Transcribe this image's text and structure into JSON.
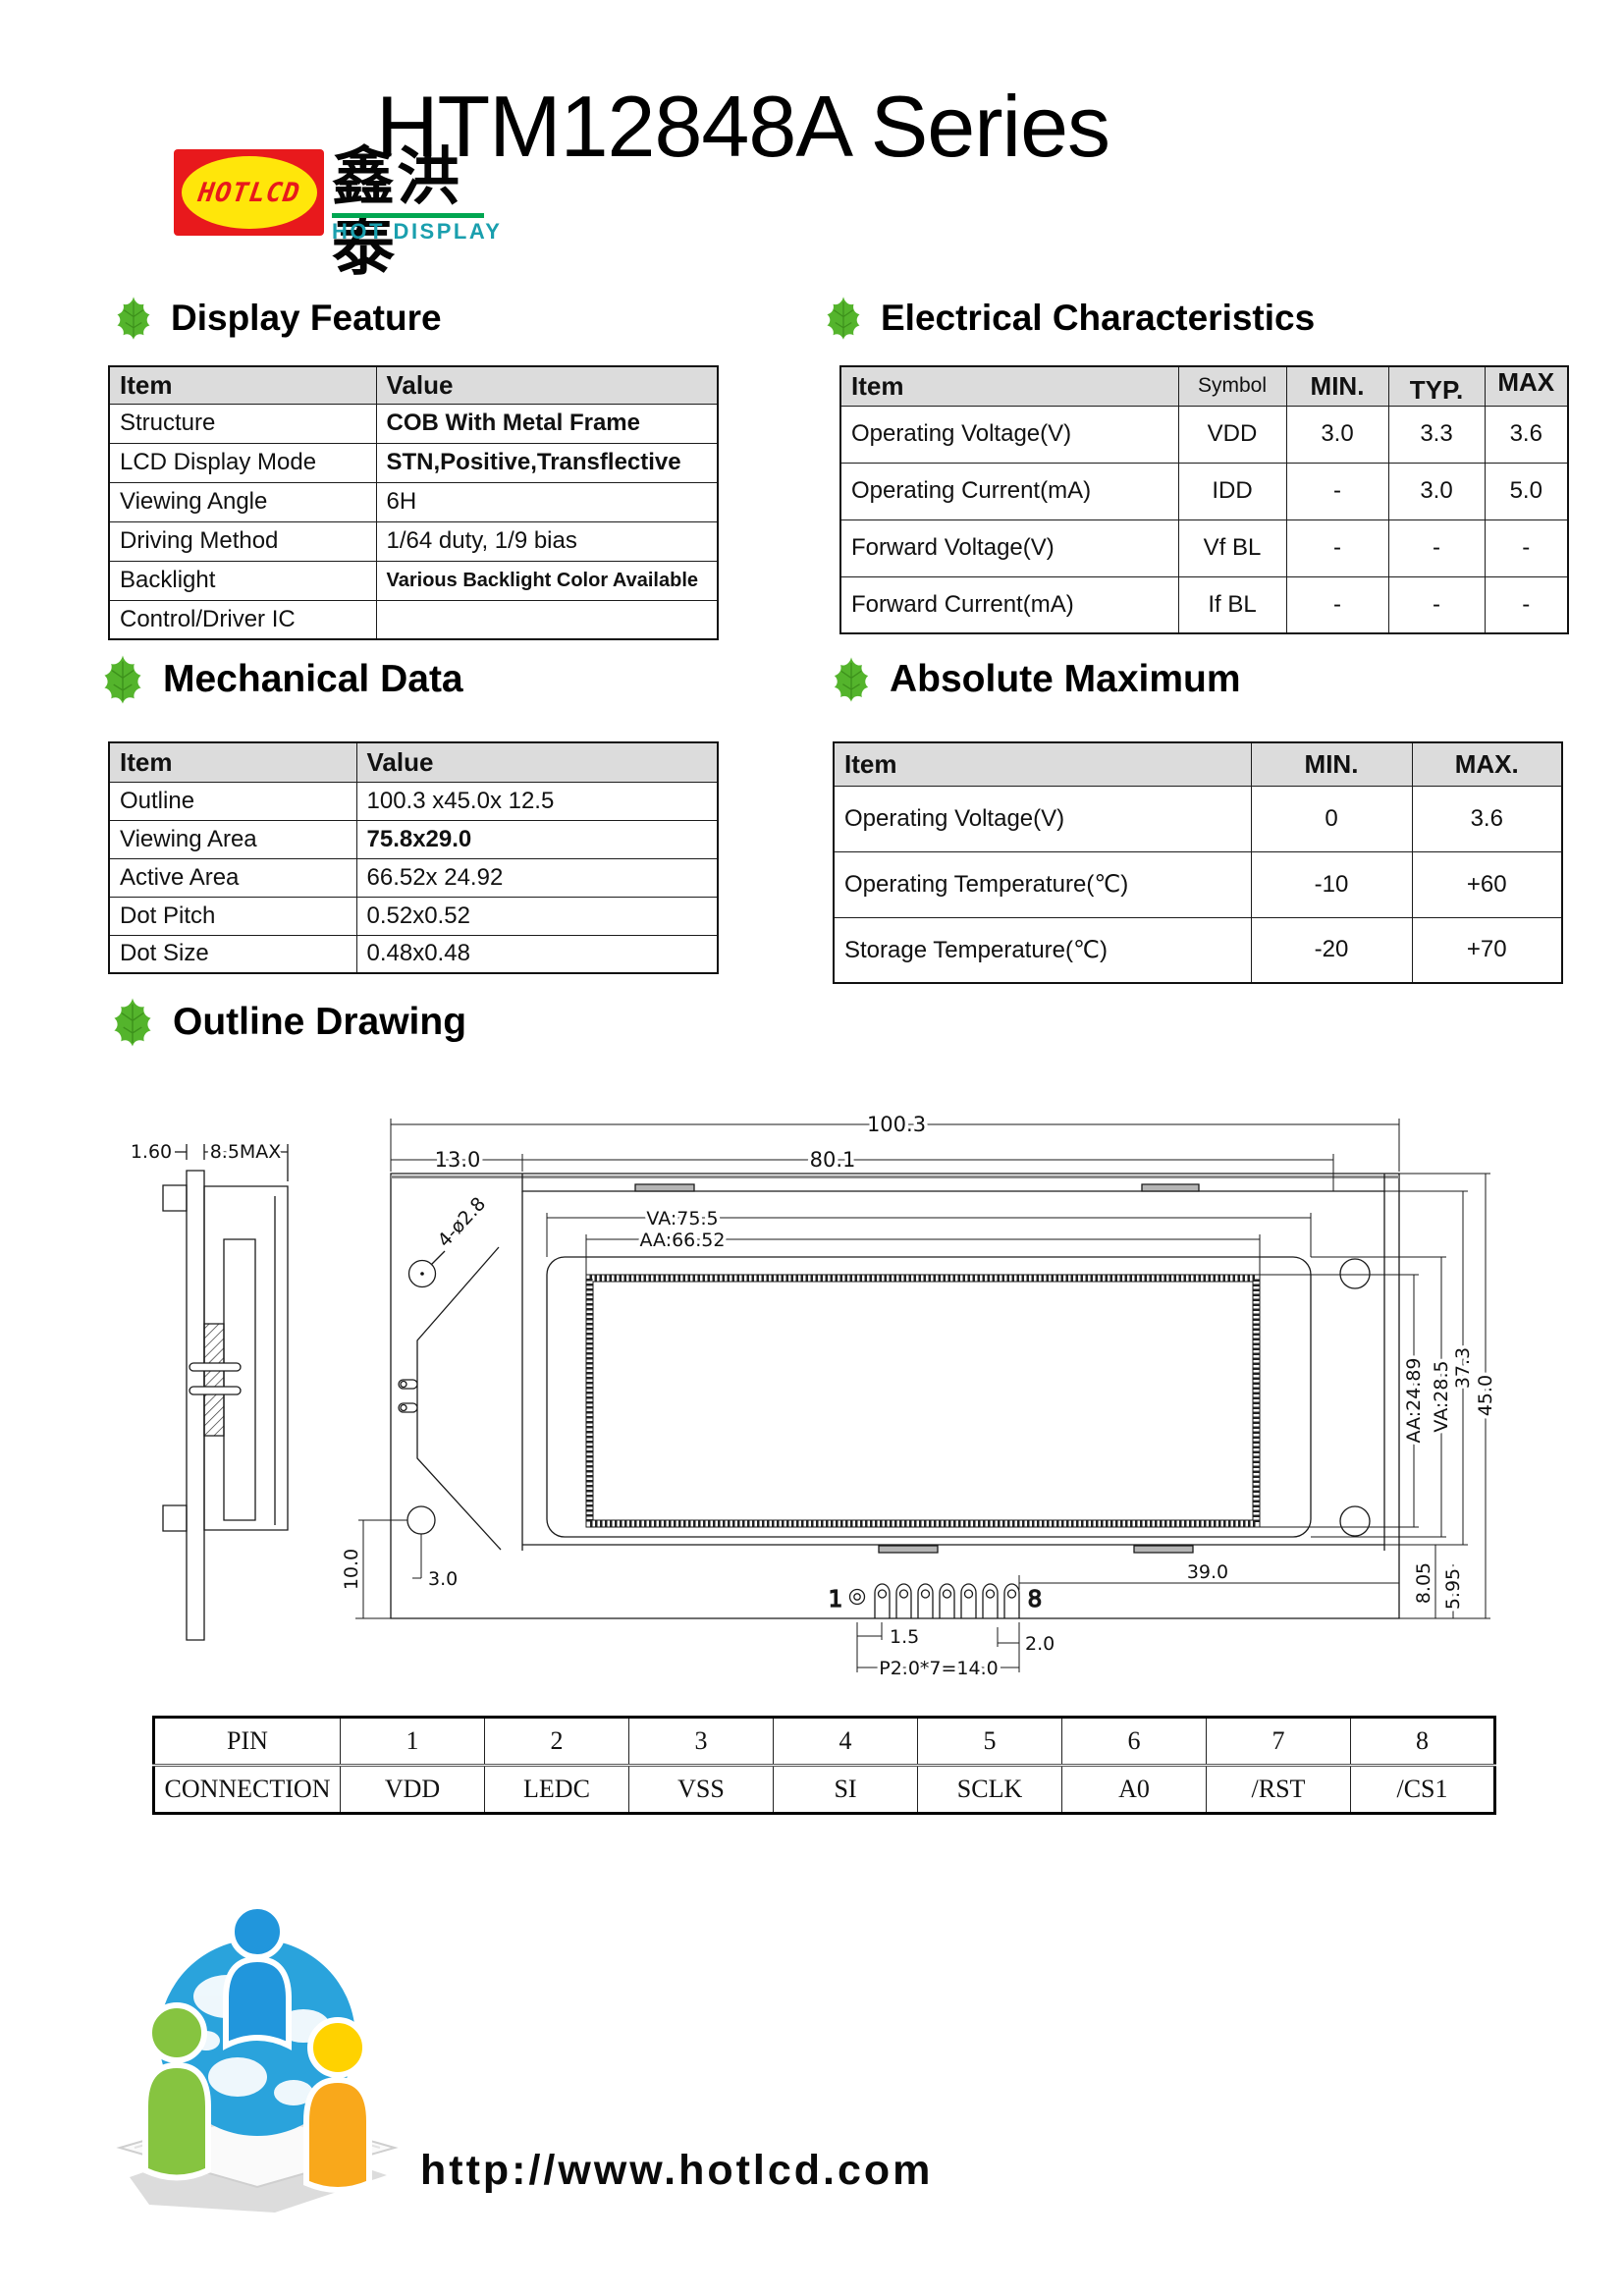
{
  "logo": {
    "mark": "HOTLCD",
    "chinese": "鑫洪泰",
    "subtitle": "HOT DISPLAY"
  },
  "title": "HTM12848A Series",
  "sections": {
    "display_feature": "Display Feature",
    "electrical": "Electrical Characteristics",
    "mechanical": "Mechanical Data",
    "absolute": "Absolute Maximum",
    "outline": "Outline Drawing"
  },
  "display_feature": {
    "headers": [
      "Item",
      "Value"
    ],
    "rows": [
      [
        "Structure",
        "COB With Metal Frame"
      ],
      [
        "LCD Display Mode",
        "STN,Positive,Transflective"
      ],
      [
        "Viewing Angle",
        "6H"
      ],
      [
        "Driving Method",
        "1/64 duty, 1/9 bias"
      ],
      [
        "Backlight",
        "Various Backlight Color Available"
      ],
      [
        "Control/Driver IC",
        ""
      ]
    ]
  },
  "electrical": {
    "headers": [
      "Item",
      "Symbol",
      "MIN.",
      "TYP.",
      "MAX"
    ],
    "rows": [
      [
        "Operating Voltage(V)",
        "VDD",
        "3.0",
        "3.3",
        "3.6"
      ],
      [
        "Operating Current(mA)",
        "IDD",
        "-",
        "3.0",
        "5.0"
      ],
      [
        "Forward Voltage(V)",
        "Vf BL",
        "-",
        "-",
        "-"
      ],
      [
        "Forward Current(mA)",
        "If BL",
        "-",
        "-",
        "-"
      ]
    ]
  },
  "mechanical": {
    "headers": [
      "Item",
      "Value"
    ],
    "rows": [
      [
        "Outline",
        "100.3 x45.0x 12.5"
      ],
      [
        "Viewing Area",
        "75.8x29.0"
      ],
      [
        "Active Area",
        "66.52x 24.92"
      ],
      [
        "Dot Pitch",
        "0.52x0.52"
      ],
      [
        "Dot Size",
        "0.48x0.48"
      ]
    ]
  },
  "absolute": {
    "headers": [
      "Item",
      "MIN.",
      "MAX."
    ],
    "rows": [
      [
        "Operating Voltage(V)",
        "0",
        "3.6"
      ],
      [
        "Operating Temperature(℃)",
        "-10",
        "+60"
      ],
      [
        "Storage Temperature(℃)",
        "-20",
        "+70"
      ]
    ]
  },
  "outline_drawing": {
    "dims": {
      "total_width": "100.3",
      "pcb_width": "80.1",
      "left_offset": "13.0",
      "va_width": "VA:75.5",
      "aa_width": "AA:66.52",
      "hole": "4-ø2.8",
      "side_pcb": "1.60",
      "side_depth": "8.5MAX",
      "aa_height": "AA:24.89",
      "va_height": "VA:28.5",
      "frame_height": "37.3",
      "total_height": "45.0",
      "d805": "8.05",
      "d595": "5.95",
      "d10": "10.0",
      "d3": "3.0",
      "d39": "39.0",
      "d15": "1.5",
      "d2": "2.0",
      "pitch": "P2.0*7=14.0",
      "pin_first": "1",
      "pin_last": "8"
    }
  },
  "pin_table": {
    "rows": [
      [
        "PIN",
        "1",
        "2",
        "3",
        "4",
        "5",
        "6",
        "7",
        "8"
      ],
      [
        "CONNECTION",
        "VDD",
        "LEDC",
        "VSS",
        "SI",
        "SCLK",
        "A0",
        "/RST",
        "/CS1"
      ]
    ]
  },
  "footer": {
    "url": "http://www.hotlcd.com"
  },
  "colors": {
    "logo_red": "#e8191c",
    "logo_yellow": "#ffe60a",
    "brand_teal": "#1a9fae",
    "brand_green": "#00a651",
    "leaf_green": "#54b42c",
    "table_header_gray": "#dcdcdc"
  }
}
